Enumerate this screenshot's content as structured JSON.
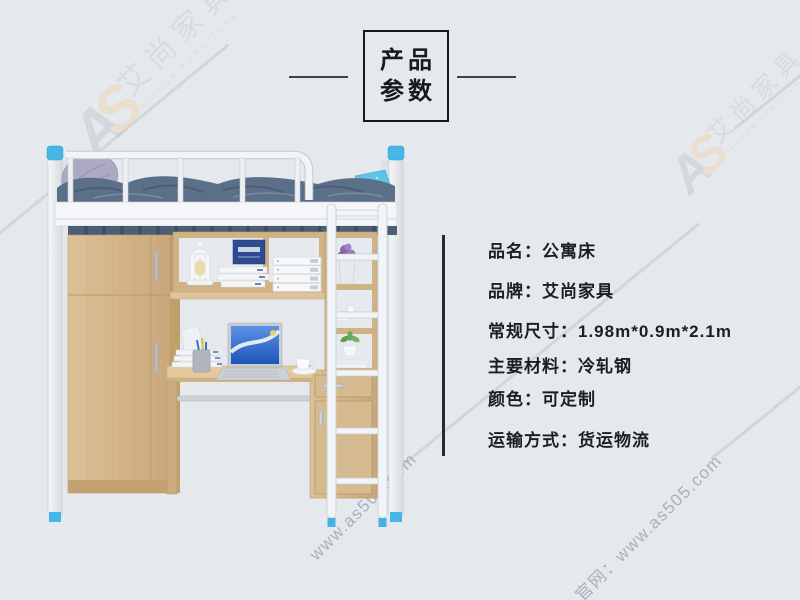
{
  "page": {
    "background_color": "#e5e9ed",
    "accent_blue": "#47b6e6",
    "text_color": "#1b1e23",
    "line_color": "#3e434a"
  },
  "title": {
    "line1": "产品",
    "line2": "参数"
  },
  "specs": {
    "colon": "：",
    "items": [
      {
        "label": "品名",
        "value": "公寓床"
      },
      {
        "label": "品牌",
        "value": "艾尚家具"
      },
      {
        "label": "常规尺寸",
        "value": "1.98m*0.9m*2.1m"
      },
      {
        "label": "主要材料",
        "value": "冷轧钢"
      },
      {
        "label": "颜色",
        "value": "可定制"
      },
      {
        "label": "运输方式",
        "value": "货运物流"
      }
    ]
  },
  "watermark": {
    "logo_a": "A",
    "logo_b": "S",
    "brand_cn": "艾尚家具",
    "brand_en": "AIRSUN FURNITURE",
    "site_text": "www.as505.com",
    "site_label": "官网：www.as505.com",
    "orange": "#ecd7b0",
    "gray": "#c9cfd7"
  },
  "product": {
    "name": "公寓床",
    "colors": {
      "wood": "#d5b98e",
      "wood_dark": "#bb9c6b",
      "bedding": "#5c6f88",
      "pillow_left": "#aba9c3",
      "pillow_right": "#5fc2e6",
      "frame_white": "#f2f5f7",
      "post_cap_blue": "#47b6e6",
      "laptop_screen_blue": "#2e6fd6"
    }
  }
}
